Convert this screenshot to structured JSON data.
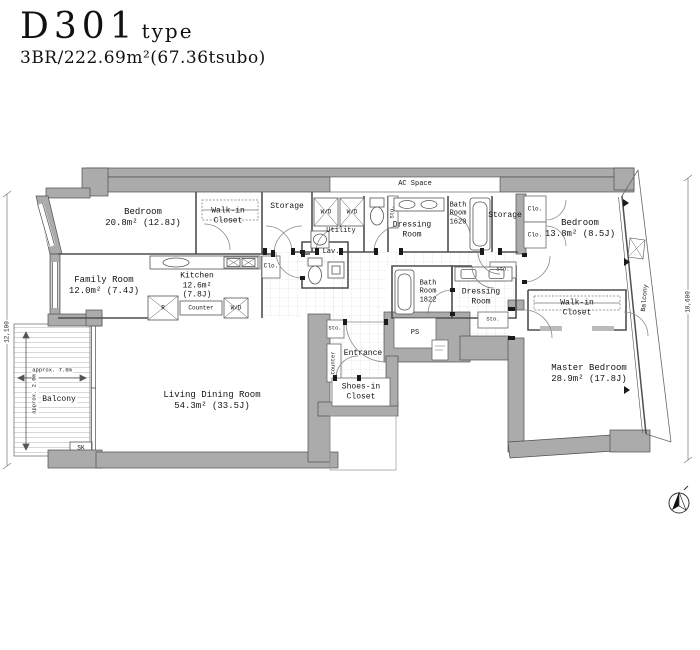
{
  "header": {
    "unit_code": "D301",
    "unit_suffix": "type",
    "spec": "3BR/222.69m²(67.36tsubo)"
  },
  "labels": {
    "ac_space": "AC Space",
    "bedroom1_name": "Bedroom",
    "bedroom1_area": "20.8m² (12.8J)",
    "bedroom2_name": "Bedroom",
    "bedroom2_area": "13.8m² (8.5J)",
    "master_name": "Master Bedroom",
    "master_area": "28.9m² (17.8J)",
    "family_name": "Family Room",
    "family_area": "12.0m² (7.4J)",
    "kitchen_name": "Kitchen",
    "kitchen_area1": "12.6m²",
    "kitchen_area2": "(7.8J)",
    "living_name": "Living Dining Room",
    "living_area": "54.3m² (33.5J)",
    "walkin_line1": "Walk-in",
    "walkin_line2": "Closet",
    "storage": "Storage",
    "bath_line1": "Bath",
    "bath_line2": "Room",
    "bath1_size": "1620",
    "bath2_size": "1822",
    "dressing_line1": "Dressing",
    "dressing_line2": "Room",
    "utility": "Utility",
    "lav": "Lav.",
    "entrance": "Entrance",
    "shoes_line1": "Shoes-in",
    "shoes_line2": "Closet",
    "balcony": "Balcony",
    "ps": "PS",
    "wd": "W/D",
    "sto": "Sto.",
    "clo": "Clo.",
    "counter": "Counter",
    "refrigerator": "R",
    "sk": "SK",
    "dim_left": "12,100",
    "dim_right": "10,600",
    "balcony_width": "approx. 7.6m",
    "balcony_depth": "approx. 2.0m"
  }
}
